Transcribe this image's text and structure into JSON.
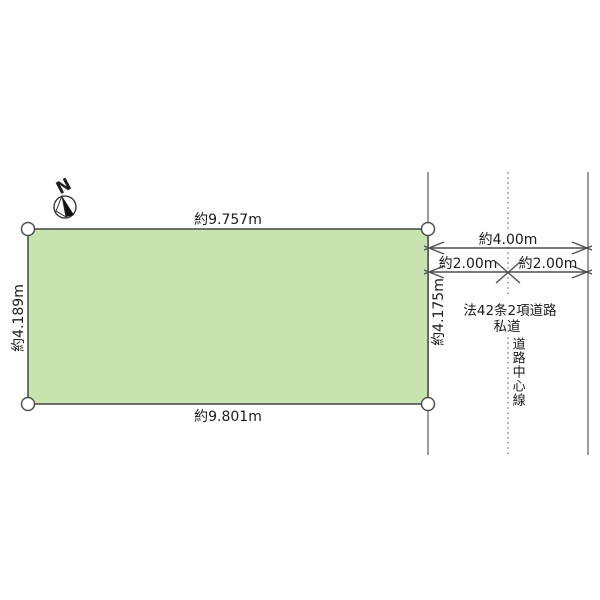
{
  "diagram": {
    "compass": {
      "north_label": "N"
    },
    "parcel": {
      "fill_color": "#c9e5af",
      "dimensions": {
        "top": "約9.757m",
        "bottom": "約9.801m",
        "left": "約4.189m",
        "right": "約4.175m"
      }
    },
    "road": {
      "total_width": "約4.00m",
      "left_half_width": "約2.00m",
      "right_half_width": "約2.00m",
      "classification": "法42条2項道路",
      "ownership": "私道",
      "centerline": "道路中心線"
    }
  }
}
